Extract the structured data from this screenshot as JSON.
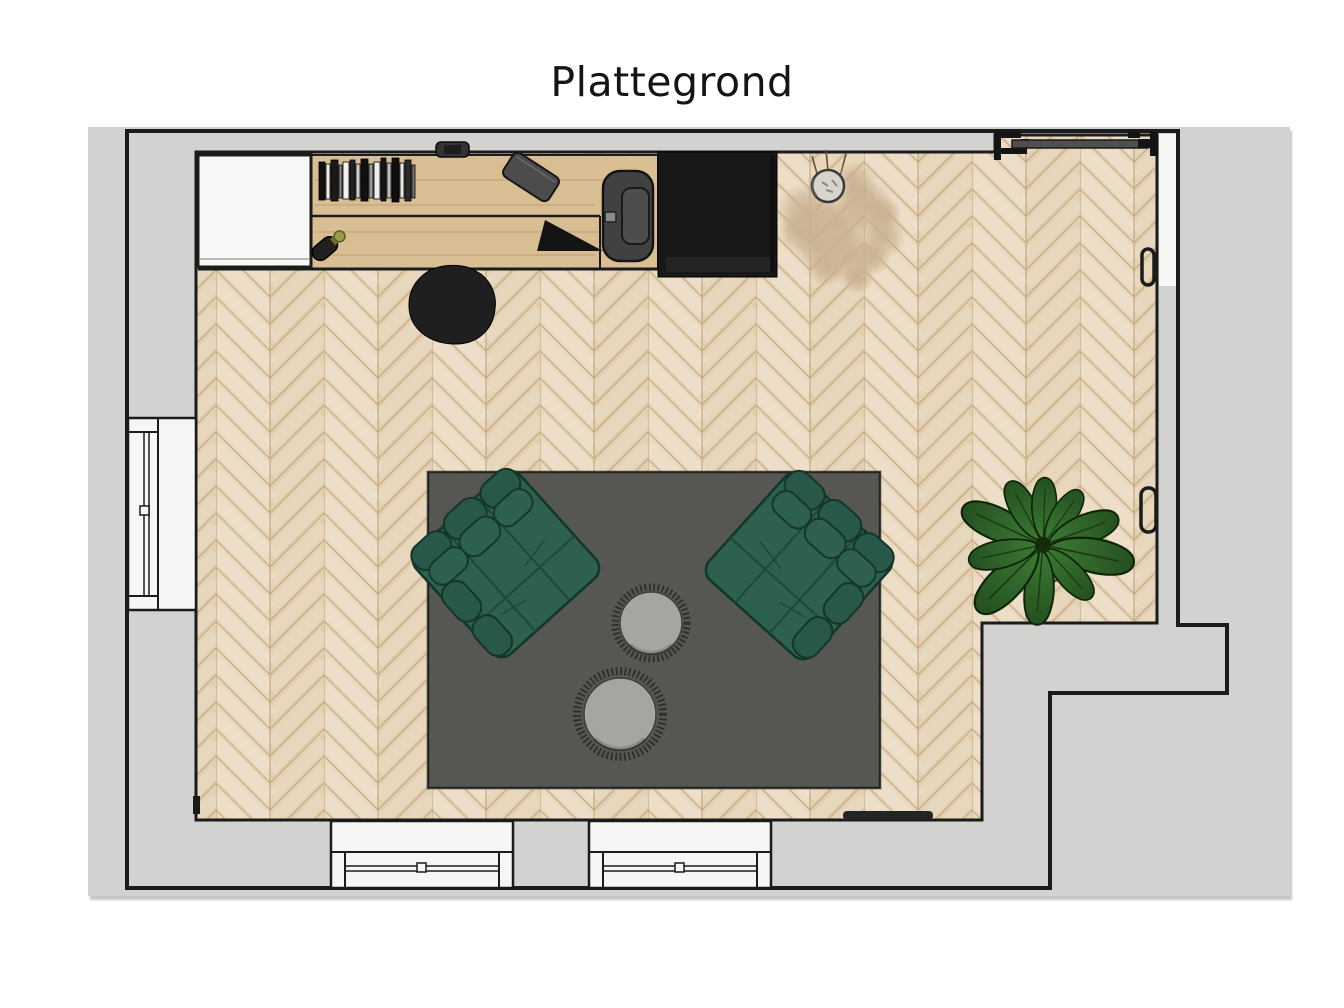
{
  "title": "Plattegrond",
  "colors": {
    "panel": "#d2d2d0",
    "outline": "#1b1b1b",
    "floor_a": "#e9d9bf",
    "floor_b": "#e3d0b1",
    "floor_seam": "#c7ab83",
    "wood": "#d9bd93",
    "cabinet_white": "#f8f8f6",
    "wardrobe_black": "#181818",
    "window_white": "#f6f6f4",
    "door_track_gray": "#4f4f4d",
    "rug_gray": "#90908a",
    "rug_border": "#3a3a36",
    "chair_green": "#2e6050",
    "chair_green_dark": "#27584a",
    "chair_seam": "#1d4a3b",
    "table_gray": "#a5a5a1",
    "fringe_dark": "#2e2e2a",
    "plant_green": "#3c7a33",
    "plant_green_dark": "#245020",
    "pampas_tan": "#c9b090",
    "vase_gray": "#d8d4cb",
    "dark_object": "#414141"
  },
  "plan_items": [
    "white cabinet",
    "wooden desk with book row",
    "bottle",
    "tablet on desk",
    "dark desk accessory",
    "basin unit",
    "black wardrobe",
    "desk chair",
    "dried pampas plant in vase",
    "sliding door with track",
    "wall handle upper",
    "wall handle lower",
    "left wall window",
    "bottom window left",
    "bottom window right",
    "area rug",
    "green armchair left",
    "green armchair right",
    "round side table small",
    "round side table large",
    "potted green plant",
    "wall bar"
  ]
}
